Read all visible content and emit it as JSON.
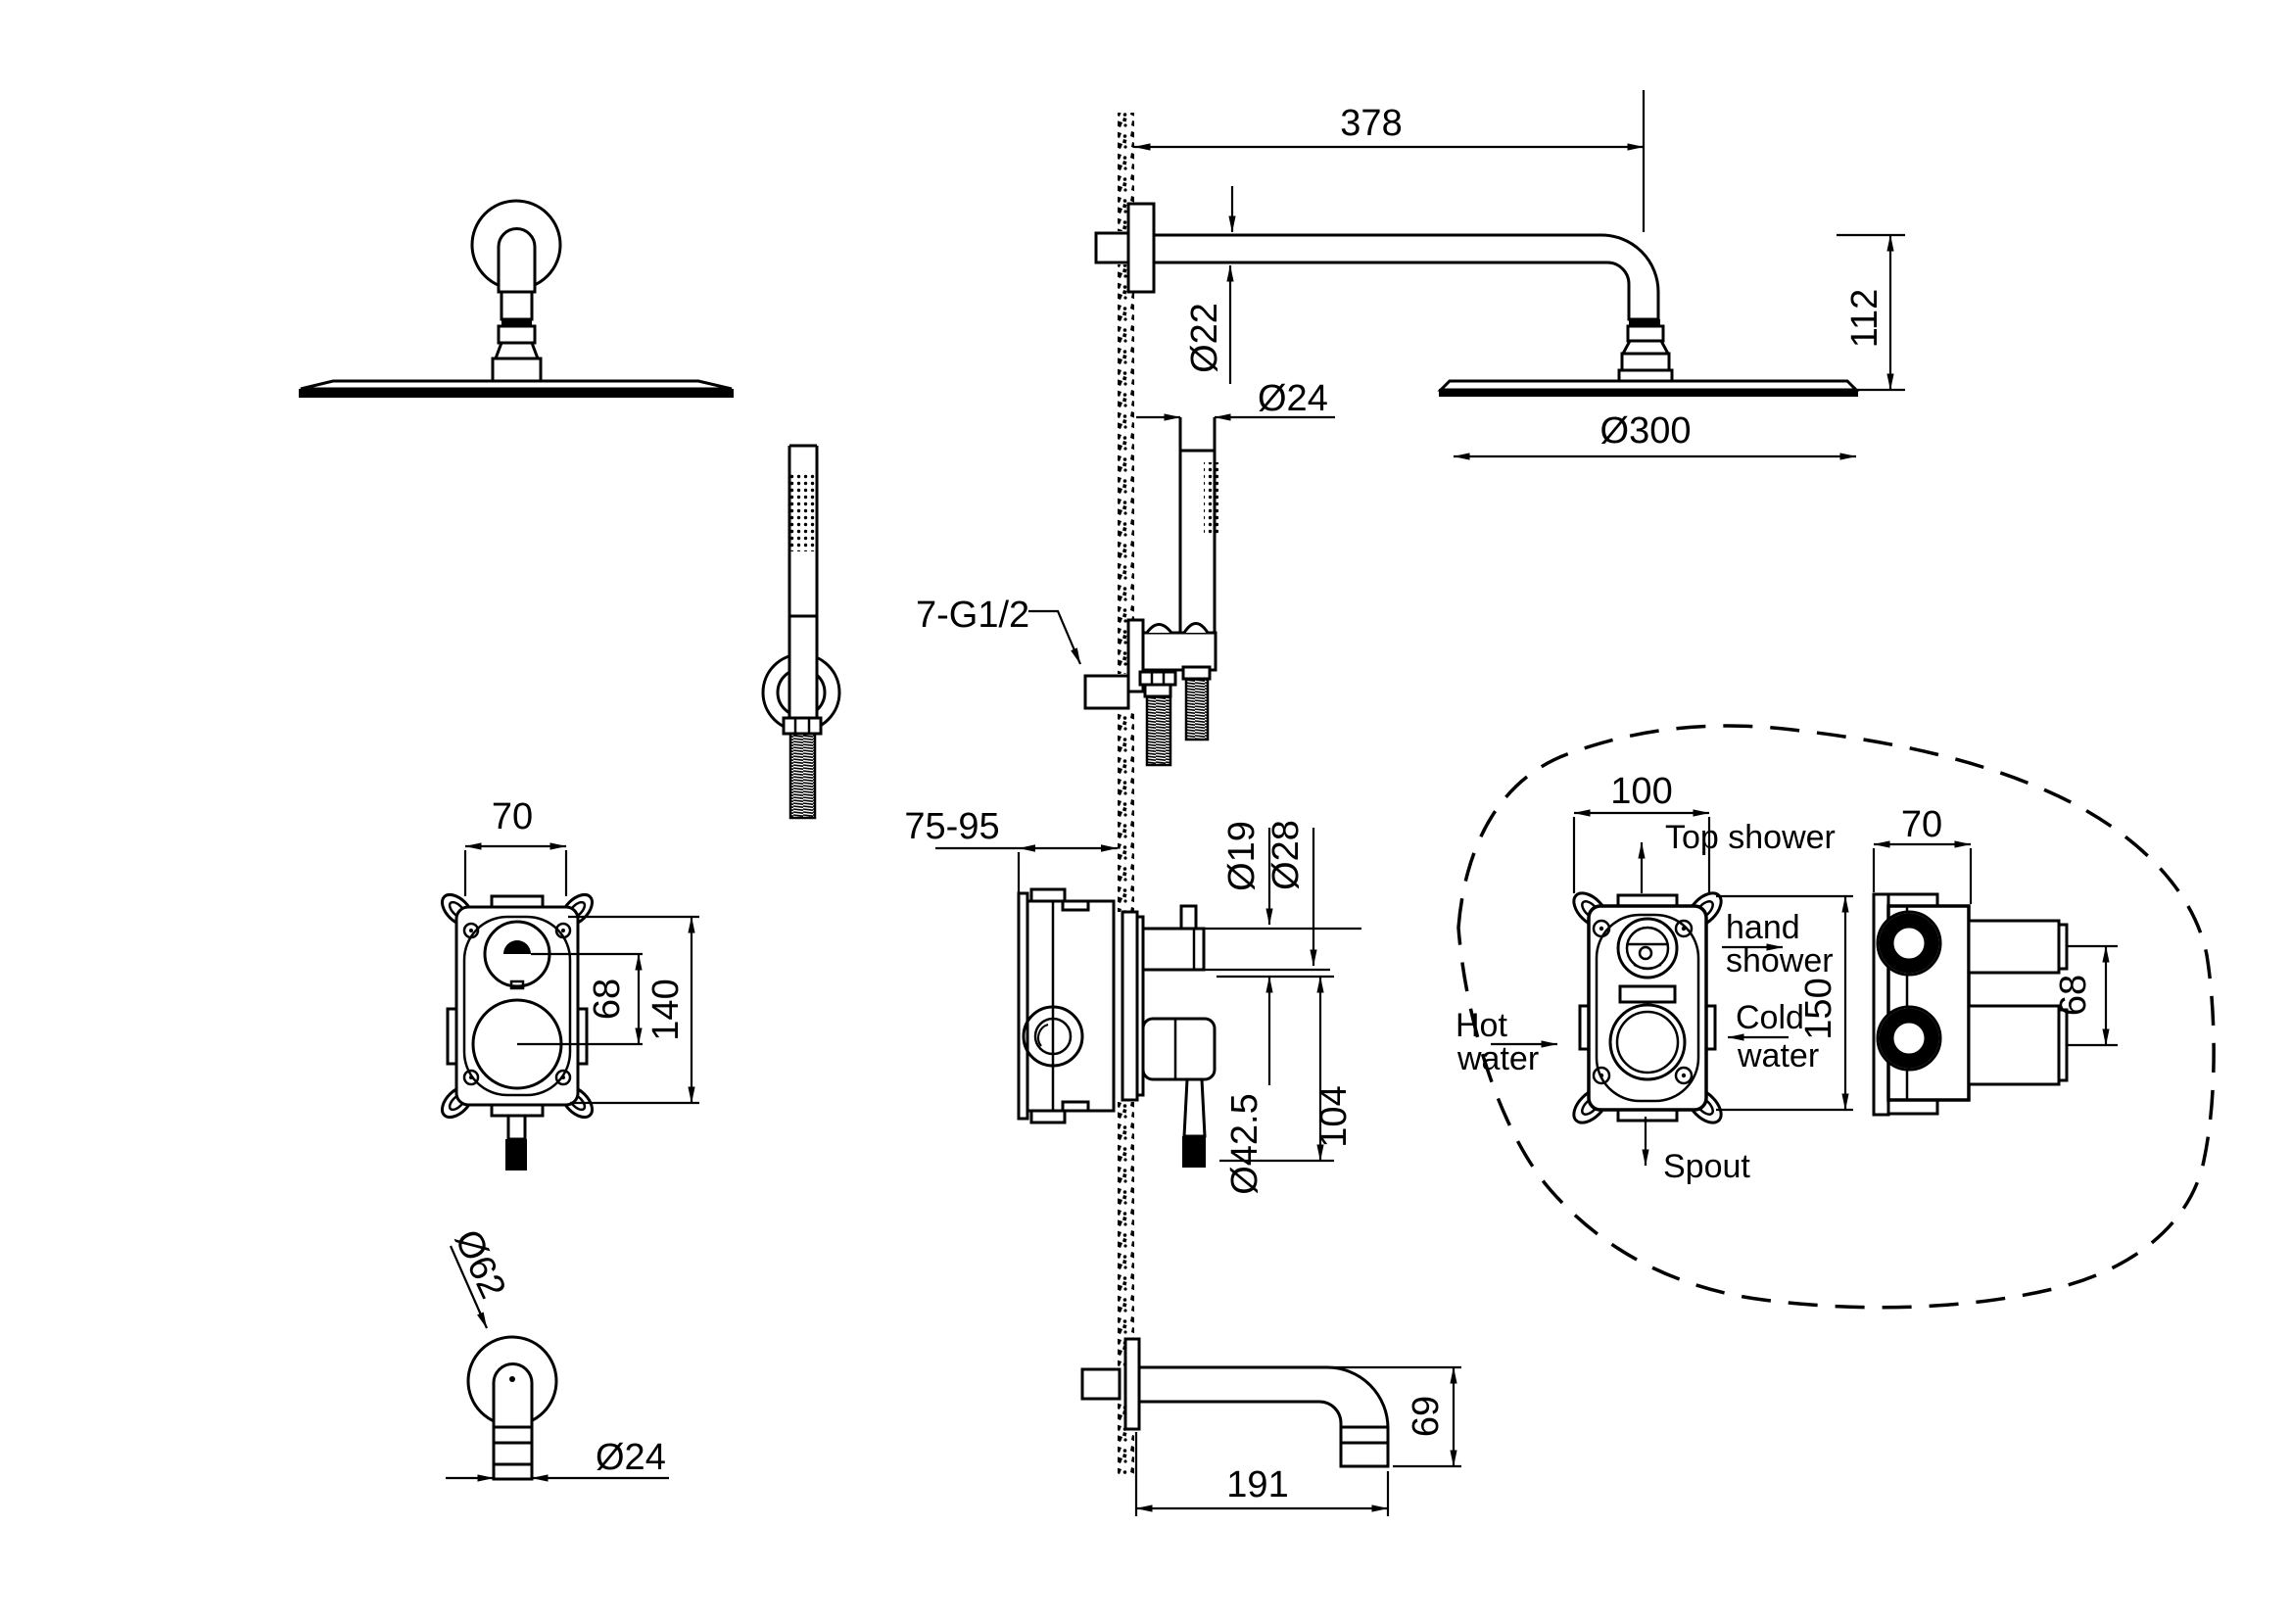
{
  "drawing": {
    "background": "#ffffff",
    "line_color": "#000000",
    "top_shower_view": {
      "arm_length": "378",
      "arm_diameter": "Ø22",
      "head_height": "112",
      "head_diameter": "Ø300",
      "hose_diameter": "Ø24",
      "connections_label": "7-G1/2"
    },
    "valve_box_front_view": {
      "width": "70",
      "port_spacing": "68",
      "height": "140"
    },
    "spout_front_view": {
      "flange_diameter": "Ø62",
      "tube_diameter": "Ø24"
    },
    "mixer_section_view": {
      "wall_depth_range": "75-95",
      "stem_diameter": "Ø19",
      "trim_diameter": "Ø28",
      "handle_diameter": "Ø42.5",
      "handle_length": "104"
    },
    "spout_side_view": {
      "length": "191",
      "height": "69"
    },
    "rough_in_detail": {
      "box_width": "100",
      "box_height": "150",
      "top_connection": "Top shower",
      "hand_connection_line1": "hand",
      "hand_connection_line2": "shower",
      "hot_line1": "Hot",
      "hot_line2": "water",
      "cold_line1": "Cold",
      "cold_line2": "water",
      "bottom_connection": "Spout",
      "side_width": "70",
      "side_port_spacing": "68"
    }
  }
}
